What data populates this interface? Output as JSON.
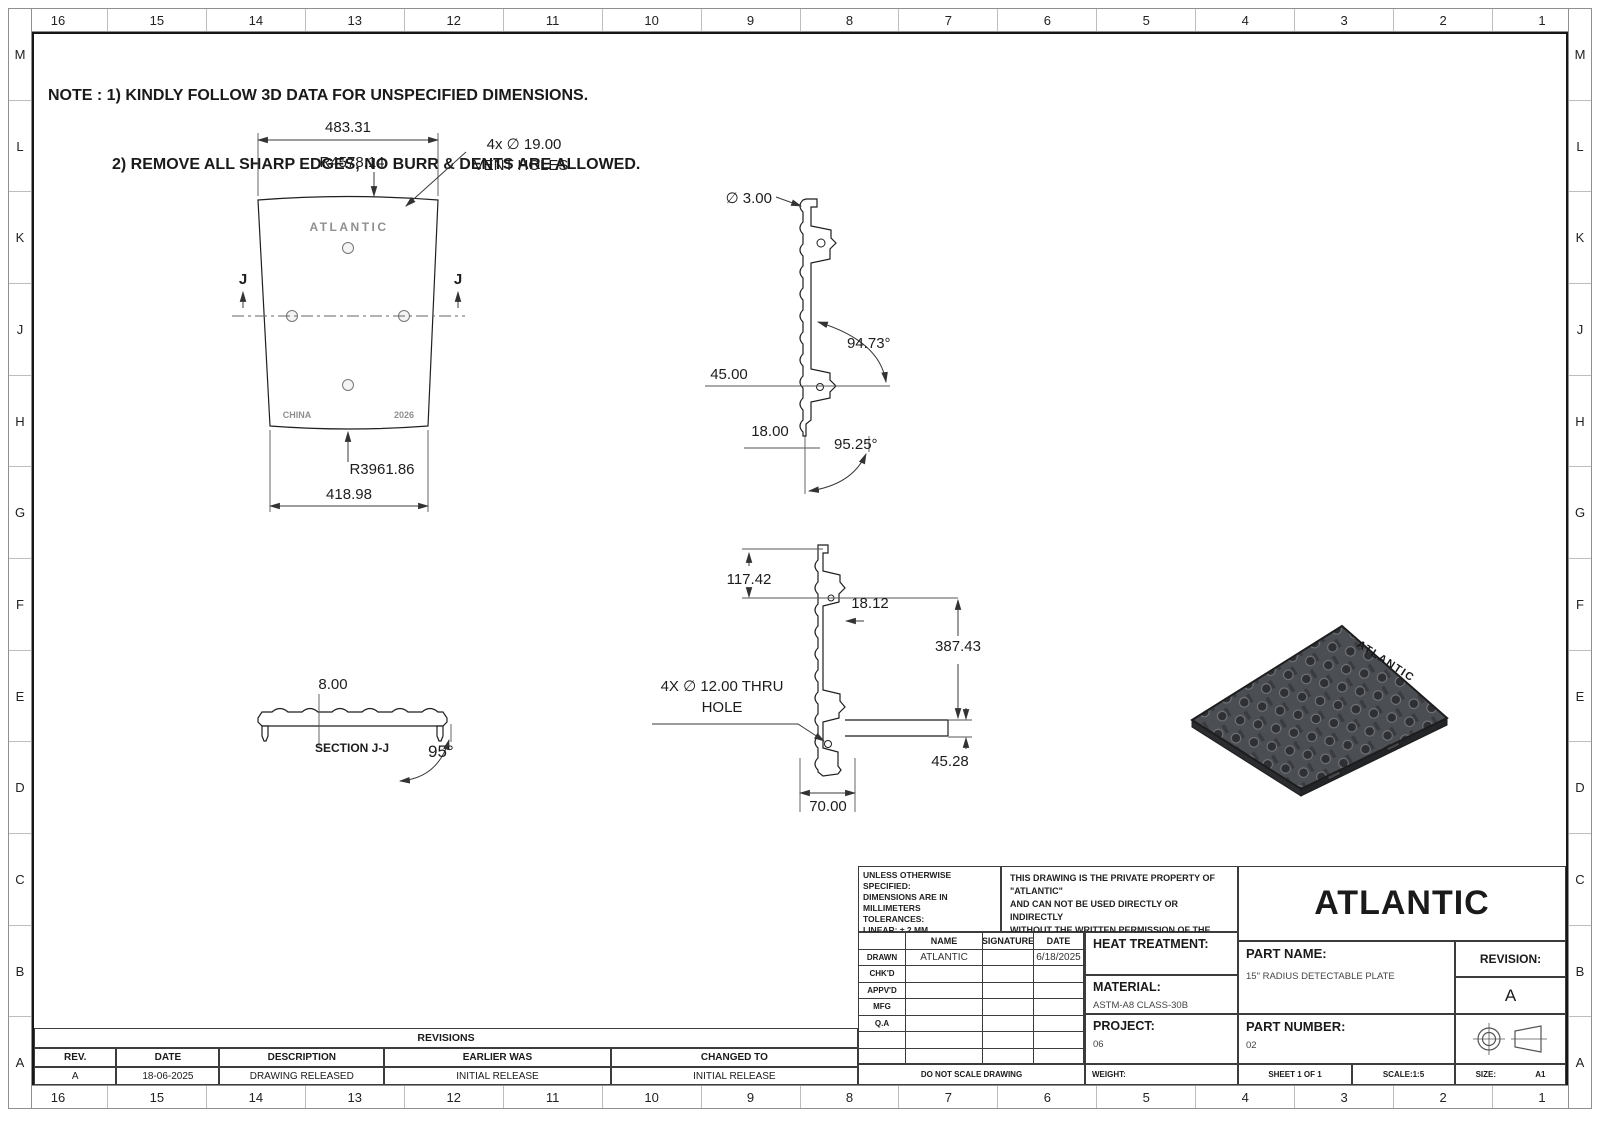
{
  "border": {
    "cols": [
      "16",
      "15",
      "14",
      "13",
      "12",
      "11",
      "10",
      "9",
      "8",
      "7",
      "6",
      "5",
      "4",
      "3",
      "2",
      "1"
    ],
    "rows": [
      "M",
      "L",
      "K",
      "J",
      "H",
      "G",
      "F",
      "E",
      "D",
      "C",
      "B",
      "A"
    ]
  },
  "notes": {
    "line1": "NOTE : 1) KINDLY FOLLOW 3D DATA FOR UNSPECIFIED DIMENSIONS.",
    "line2": "2) REMOVE ALL SHARP EDGES, NO BURR & DENTS ARE ALLOWED."
  },
  "plan_view": {
    "dim_top_width": "483.31",
    "dim_top_radius": "R4578.14",
    "vent_callout_line1": "4x ∅ 19.00",
    "vent_callout_line2": "VENT HOLES",
    "section_letter": "J",
    "emboss_brand": "ATLANTIC",
    "emboss_origin": "CHINA",
    "emboss_year": "2026",
    "dim_bottom_radius": "R3961.86",
    "dim_bottom_width": "418.98"
  },
  "side_view": {
    "dim_diameter": "∅ 3.00",
    "dim_angle_top": "94.73°",
    "dim_offset": "45.00",
    "dim_edge": "18.00",
    "dim_angle_bottom": "95.25°"
  },
  "section_view": {
    "dim_thickness": "8.00",
    "label": "SECTION J-J",
    "dim_angle": "95°"
  },
  "profile_view": {
    "dim_top": "117.42",
    "dim_tab": "18.12",
    "dim_height": "387.43",
    "thru_hole_line1": "4X ∅ 12.00 THRU",
    "thru_hole_line2": "HOLE",
    "dim_rail": "45.28",
    "dim_foot": "70.00"
  },
  "iso_view": {
    "emboss_brand": "ATLANTIC"
  },
  "title_block": {
    "tolerances": [
      "UNLESS OTHERWISE SPECIFIED:",
      "DIMENSIONS ARE IN MILLIMETERS",
      "TOLERANCES:",
      "LINEAR: ± 2 MM",
      "ANGULAR: ± 1°",
      "BRK/FILE SHARP CORNER: 1 MM MAX",
      "SURFACE FINISH: 20 - 50"
    ],
    "property": [
      "THIS DRAWING IS THE PRIVATE PROPERTY OF \"ATLANTIC\"",
      "AND CAN NOT BE USED DIRECTLY OR INDIRECTLY",
      "WITHOUT THE WRITTEN PERMISSION  OF THE COMPANY.",
      "ALL LEGAL RIGHTS RESERVED."
    ],
    "company": "ATLANTIC",
    "signoff": {
      "headers": [
        "NAME",
        "SIGNATURE",
        "DATE"
      ],
      "rows": [
        {
          "label": "DRAWN",
          "name": "ATLANTIC",
          "signature": "",
          "date": "6/18/2025"
        },
        {
          "label": "CHK'D",
          "name": "",
          "signature": "",
          "date": ""
        },
        {
          "label": "APPV'D",
          "name": "",
          "signature": "",
          "date": ""
        },
        {
          "label": "MFG",
          "name": "",
          "signature": "",
          "date": ""
        },
        {
          "label": "Q.A",
          "name": "",
          "signature": "",
          "date": ""
        }
      ]
    },
    "heat_treatment_label": "HEAT TREATMENT:",
    "heat_treatment_value": "",
    "material_label": "MATERIAL:",
    "material_value": "ASTM-A8 CLASS-30B",
    "project_label": "PROJECT:",
    "project_value": "06",
    "part_name_label": "PART NAME:",
    "part_name_value": "15\" RADIUS DETECTABLE PLATE",
    "revision_label": "REVISION:",
    "revision_value": "A",
    "part_number_label": "PART NUMBER:",
    "part_number_value": "02",
    "do_not_scale": "DO NOT SCALE DRAWING",
    "weight_label": "WEIGHT:",
    "sheet": "SHEET 1 OF 1",
    "scale": "SCALE:1:5",
    "size_label": "SIZE:",
    "size_value": "A1"
  },
  "revisions": {
    "title": "REVISIONS",
    "headers": [
      "REV.",
      "DATE",
      "DESCRIPTION",
      "EARLIER WAS",
      "CHANGED TO"
    ],
    "rows": [
      [
        "A",
        "18-06-2025",
        "DRAWING RELEASED",
        "INITIAL RELEASE",
        "INITIAL RELEASE"
      ]
    ]
  }
}
